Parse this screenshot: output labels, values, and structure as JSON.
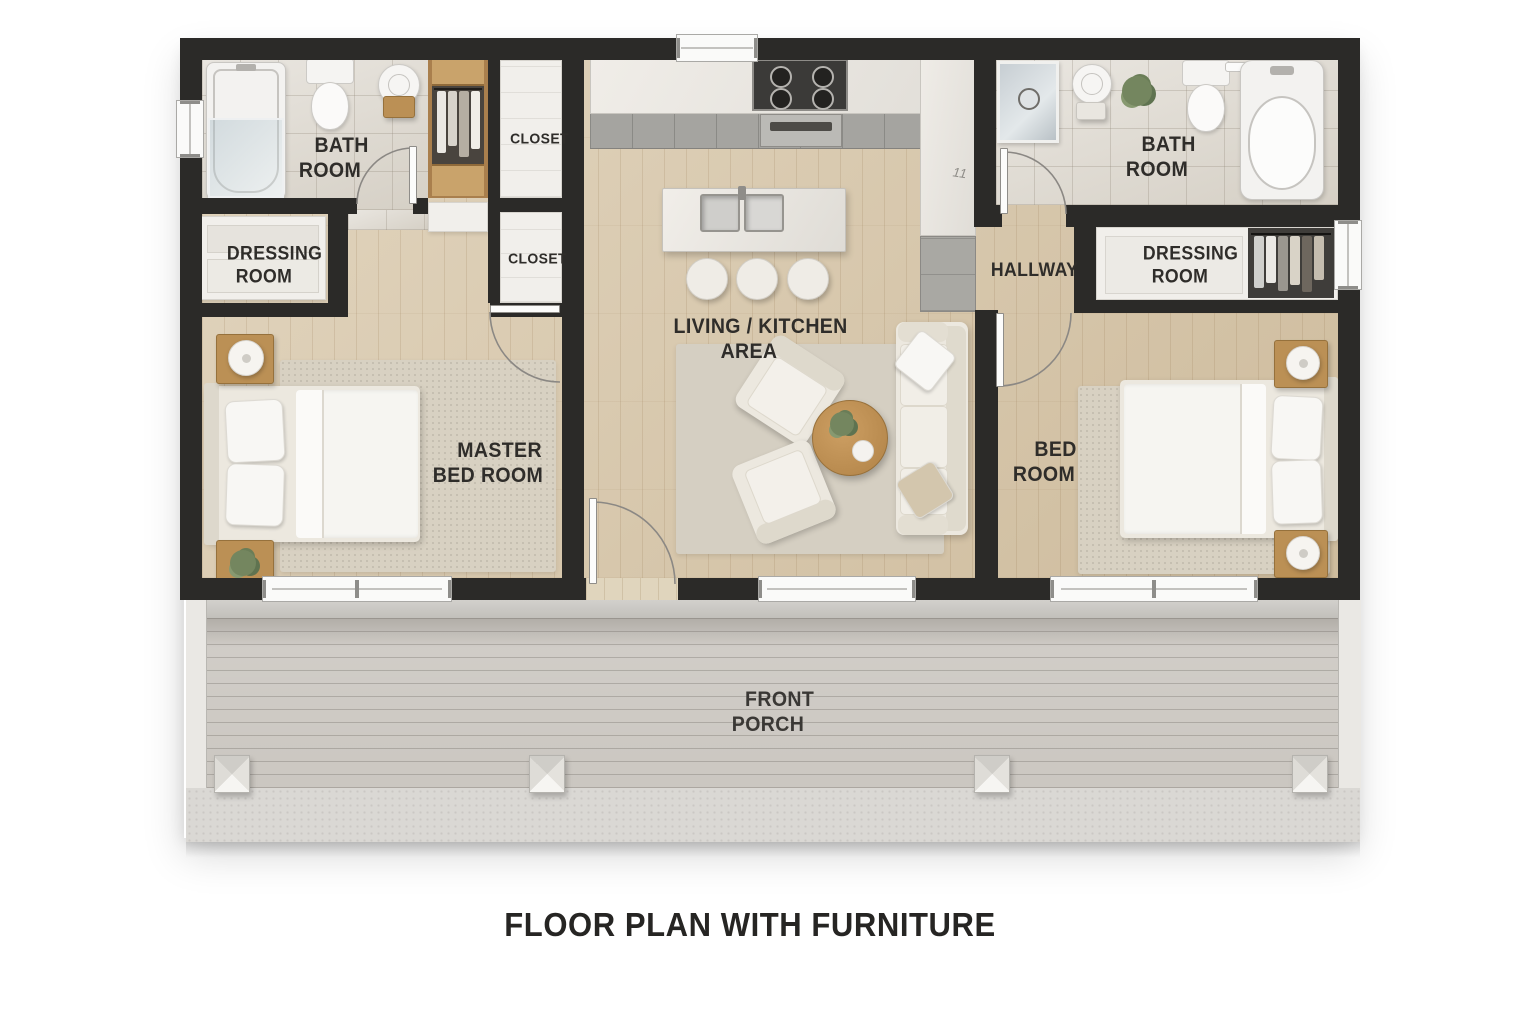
{
  "title": "FLOOR PLAN WITH FURNITURE",
  "rooms": {
    "bath_left": {
      "line1": "BATH",
      "line2": "ROOM"
    },
    "closet_top": {
      "line1": "CLOSET"
    },
    "closet_bottom": {
      "line1": "CLOSET"
    },
    "dressing_left": {
      "line1": "DRESSING",
      "line2": "ROOM"
    },
    "master_bedroom": {
      "line1": "MASTER",
      "line2": "BED ROOM"
    },
    "living_kitchen": {
      "line1": "LIVING / KITCHEN",
      "line2": "AREA"
    },
    "hallway": {
      "line1": "HALLWAY"
    },
    "bath_right": {
      "line1": "BATH",
      "line2": "ROOM"
    },
    "dressing_right": {
      "line1": "DRESSING",
      "line2": "ROOM"
    },
    "bedroom": {
      "line1": "BED",
      "line2": "ROOM"
    },
    "front_porch": {
      "line1": "FRONT",
      "line2": "PORCH"
    }
  },
  "markings": {
    "kitchen_counter": "11"
  },
  "colors": {
    "wall": "#2b2a28",
    "wood_floor": "#d8c7a9",
    "tile_floor": "#ded9d0",
    "deck": "#cbc7c1",
    "concrete": "#dad8d4",
    "label_text": "#2f2d2a"
  }
}
